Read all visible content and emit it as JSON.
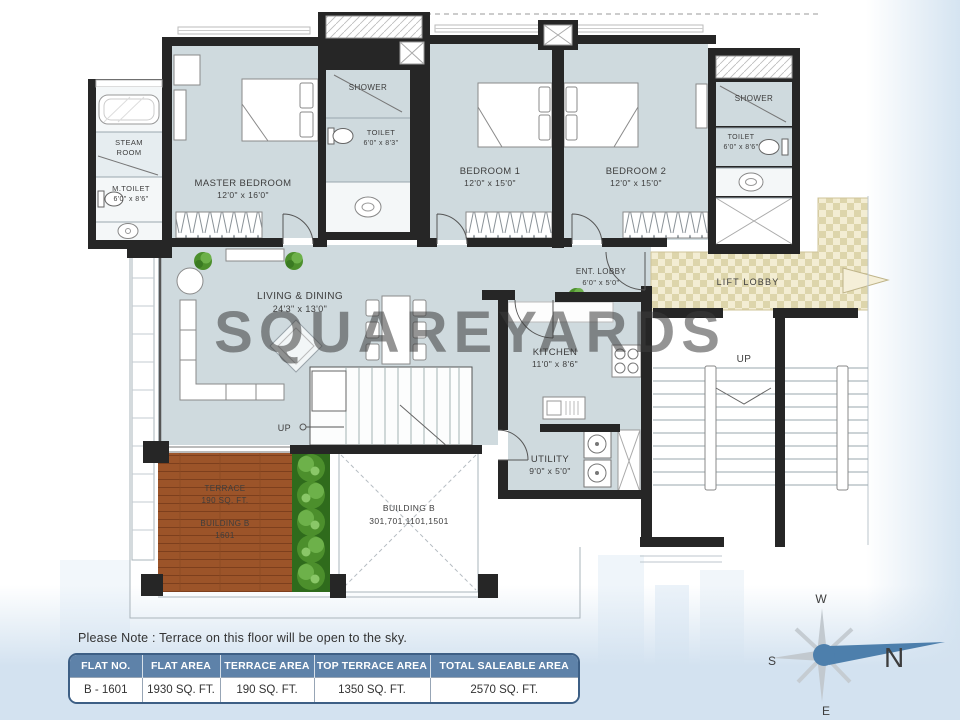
{
  "watermark": "SQUAREYARDS",
  "note": "Please Note : Terrace on this floor will be open to the sky.",
  "plan": {
    "steam_room": {
      "line1": "STEAM",
      "line2": "ROOM"
    },
    "m_toilet": {
      "name": "M.TOILET",
      "dims": "6'0\" x 8'6\""
    },
    "master_bedroom": {
      "name": "MASTER BEDROOM",
      "dims": "12'0\" x 16'0\""
    },
    "shower_left": {
      "name": "SHOWER"
    },
    "toilet_left": {
      "name": "TOILET",
      "dims": "6'0\" x 8'3\""
    },
    "bedroom_1": {
      "name": "BEDROOM 1",
      "dims": "12'0\" x 15'0\""
    },
    "bedroom_2": {
      "name": "BEDROOM 2",
      "dims": "12'0\" x 15'0\""
    },
    "shower_right": {
      "name": "SHOWER"
    },
    "toilet_right": {
      "name": "TOILET",
      "dims": "6'0\" x 8'6\""
    },
    "living_dining": {
      "name": "LIVING  & DINING",
      "dims": "24'3\" x 13'0\""
    },
    "ent_lobby": {
      "name": "ENT. LOBBY",
      "dims": "6'0\" x 5'0\""
    },
    "lift_lobby": {
      "name": "LIFT LOBBY"
    },
    "kitchen": {
      "name": "KITCHEN",
      "dims": "11'0\" x 8'6\""
    },
    "utility": {
      "name": "UTILITY",
      "dims": "9'0\" x 5'0\""
    },
    "terrace": {
      "name": "TERRACE",
      "area": "190 SQ. FT.",
      "building": "BUILDING  B",
      "unit": "1601"
    },
    "building_void": {
      "name": "BUILDING  B",
      "units": "301,701,1101,1501"
    },
    "up_inner": "UP",
    "up_outer": "UP"
  },
  "area_table": {
    "headers": [
      "FLAT NO.",
      "FLAT AREA",
      "TERRACE AREA",
      "TOP TERRACE AREA",
      "TOTAL SALEABLE AREA"
    ],
    "row": [
      "B - 1601",
      "1930 SQ. FT.",
      "190 SQ. FT.",
      "1350 SQ. FT.",
      "2570 SQ. FT."
    ]
  },
  "compass": {
    "w": "W",
    "n": "N",
    "s": "S",
    "e": "E"
  },
  "colors": {
    "wall": "#262626",
    "room_fill": "#cfdade",
    "lift_lobby": "#f3edd3",
    "terrace_wood": "#9c5429",
    "table_header": "#5e82a9",
    "watermark": "#8ec6de",
    "compass_accent": "#4d7fac"
  }
}
